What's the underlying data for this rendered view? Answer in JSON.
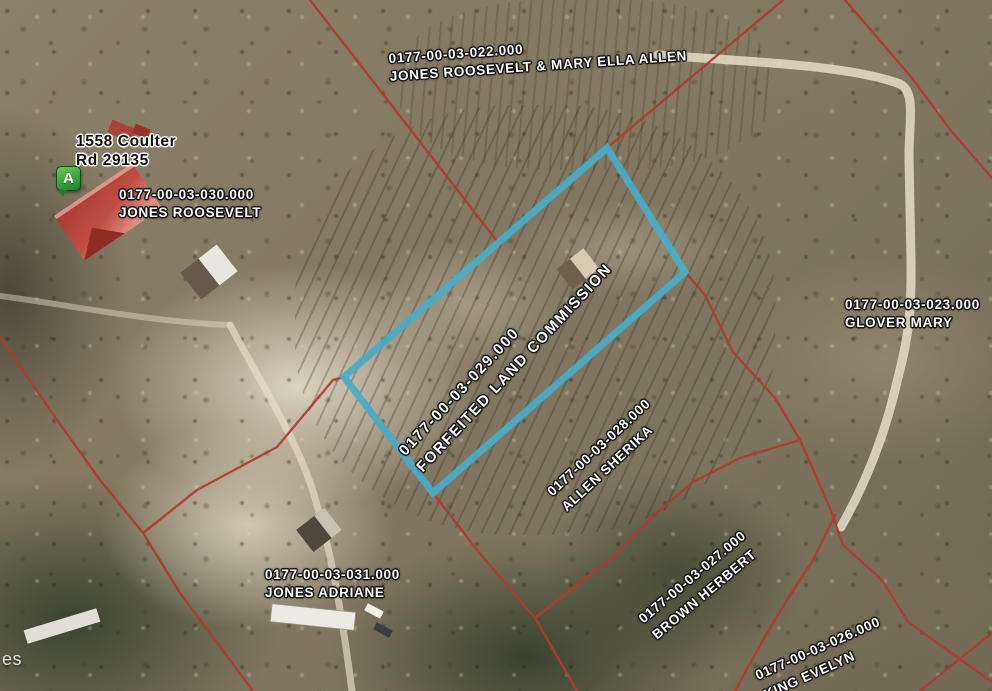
{
  "map": {
    "selected_parcel": "0177-00-03-029.000",
    "watermark_fragment": "es"
  },
  "marker": {
    "letter": "A"
  },
  "address_label": {
    "line1": "1558 Coulter",
    "line2": "Rd 29135"
  },
  "parcels": [
    {
      "id": "0177-00-03-022.000",
      "owner": "JONES ROOSEVELT & MARY ELLA ALLEN",
      "selected": false
    },
    {
      "id": "0177-00-03-030.000",
      "owner": "JONES ROOSEVELT",
      "selected": false
    },
    {
      "id": "0177-00-03-029.000",
      "owner": "FORFEITED LAND COMMISSION",
      "selected": true
    },
    {
      "id": "0177-00-03-023.000",
      "owner": "GLOVER MARY",
      "selected": false
    },
    {
      "id": "0177-00-03-028.000",
      "owner": "ALLEN SHERIKA",
      "selected": false
    },
    {
      "id": "0177-00-03-031.000",
      "owner": "JONES ADRIANE",
      "selected": false
    },
    {
      "id": "0177-00-03-027.000",
      "owner": "BROWN HERBERT",
      "selected": false
    },
    {
      "id": "0177-00-03-026.000",
      "owner": "KING EVELYN",
      "selected": false
    }
  ],
  "colors": {
    "highlight": "#46adc9",
    "boundary": "#b23a2c",
    "label_text": "#ffffff",
    "label_halo": "#141414",
    "address_text": "#101010",
    "marker_green": "#3da33c"
  }
}
